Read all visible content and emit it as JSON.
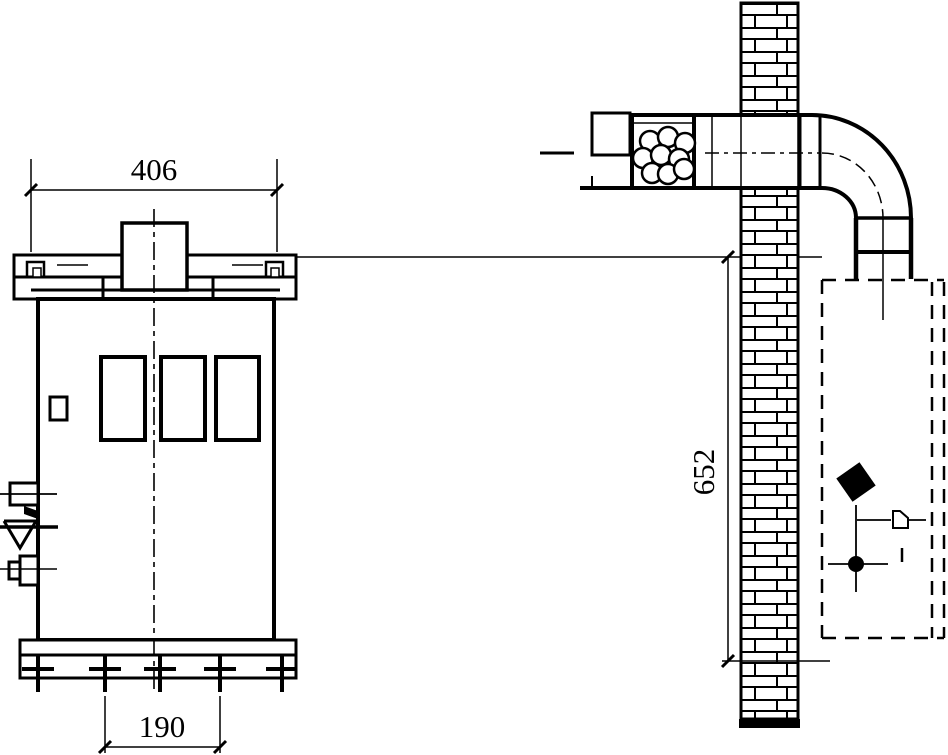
{
  "drawing": {
    "type": "technical-installation-drawing",
    "background_color": "#ffffff",
    "line_color": "#000000",
    "views": {
      "front": {
        "dimensions": {
          "top_width": "406",
          "anchor_spacing": "190"
        }
      },
      "side": {
        "dimensions": {
          "height": "652"
        }
      }
    }
  }
}
